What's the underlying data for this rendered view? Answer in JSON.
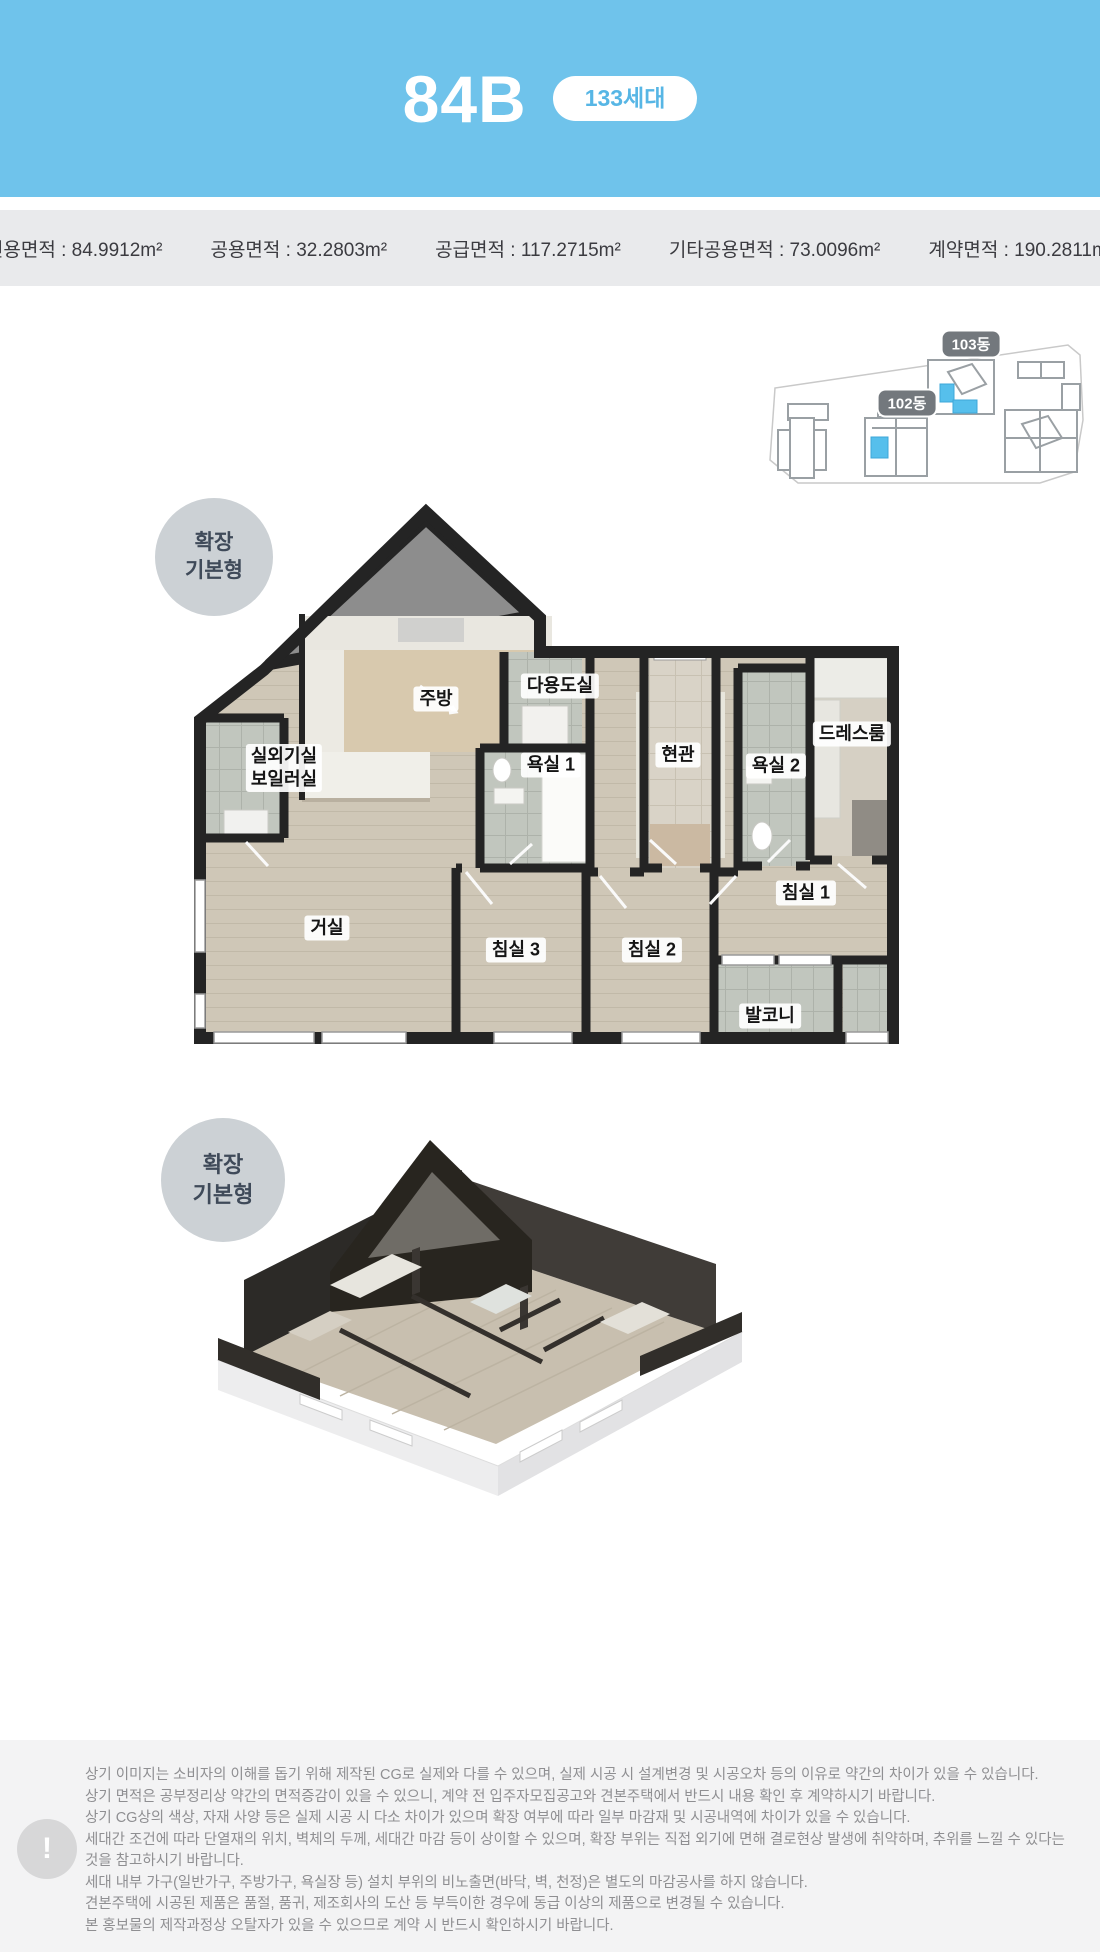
{
  "header": {
    "title": "84B",
    "units_badge": "133세대",
    "bg_color": "#6fc3eb"
  },
  "area_bar": {
    "items": [
      "전용면적 : 84.9912m²",
      "공용면적 : 32.2803m²",
      "공급면적 : 117.2715m²",
      "기타공용면적 : 73.0096m²",
      "계약면적 : 190.2811m²"
    ]
  },
  "site_plan": {
    "building_103": "103동",
    "building_102": "102동",
    "highlight_color": "#56bfec"
  },
  "plan_2d": {
    "badge_line1": "확장",
    "badge_line2": "기본형",
    "rooms": {
      "kitchen": "주방",
      "utility": "다용도실",
      "outdoor_unit": "실외기실",
      "boiler": "보일러실",
      "bath1": "욕실 1",
      "entrance": "현관",
      "bath2": "욕실 2",
      "dressroom": "드레스룸",
      "living": "거실",
      "bedroom3": "침실 3",
      "bedroom2": "침실 2",
      "bedroom1": "침실 1",
      "balcony": "발코니"
    }
  },
  "plan_3d": {
    "badge_line1": "확장",
    "badge_line2": "기본형"
  },
  "footer": {
    "icon": "!",
    "lines": [
      "상기 이미지는 소비자의 이해를 돕기 위해 제작된 CG로 실제와 다를 수 있으며, 실제 시공 시 설계변경 및 시공오차 등의 이유로 약간의 차이가 있을 수 있습니다.",
      "상기 면적은 공부정리상 약간의 면적증감이 있을 수 있으니, 계약 전 입주자모집공고와 견본주택에서 반드시 내용 확인 후 계약하시기 바랍니다.",
      "상기 CG상의 색상, 자재 사양 등은 실제 시공 시 다소 차이가 있으며 확장 여부에 따라 일부 마감재 및 시공내역에 차이가 있을 수 있습니다.",
      "세대간 조건에 따라 단열재의 위치, 벽체의 두께, 세대간 마감 등이 상이할 수 있으며, 확장 부위는 직접 외기에 면해 결로현상 발생에 취약하며, 추위를 느낄 수 있다는 것을 참고하시기 바랍니다.",
      "세대 내부 가구(일반가구, 주방가구, 욕실장 등) 설치 부위의 비노출면(바닥, 벽, 천정)은 별도의 마감공사를 하지 않습니다.",
      "견본주택에 시공된 제품은 품절, 품귀, 제조회사의 도산 등 부득이한 경우에 동급 이상의 제품으로 변경될 수 있습니다.",
      "본 홍보물의 제작과정상 오탈자가 있을 수 있으므로 계약 시 반드시 확인하시기 바랍니다."
    ]
  }
}
